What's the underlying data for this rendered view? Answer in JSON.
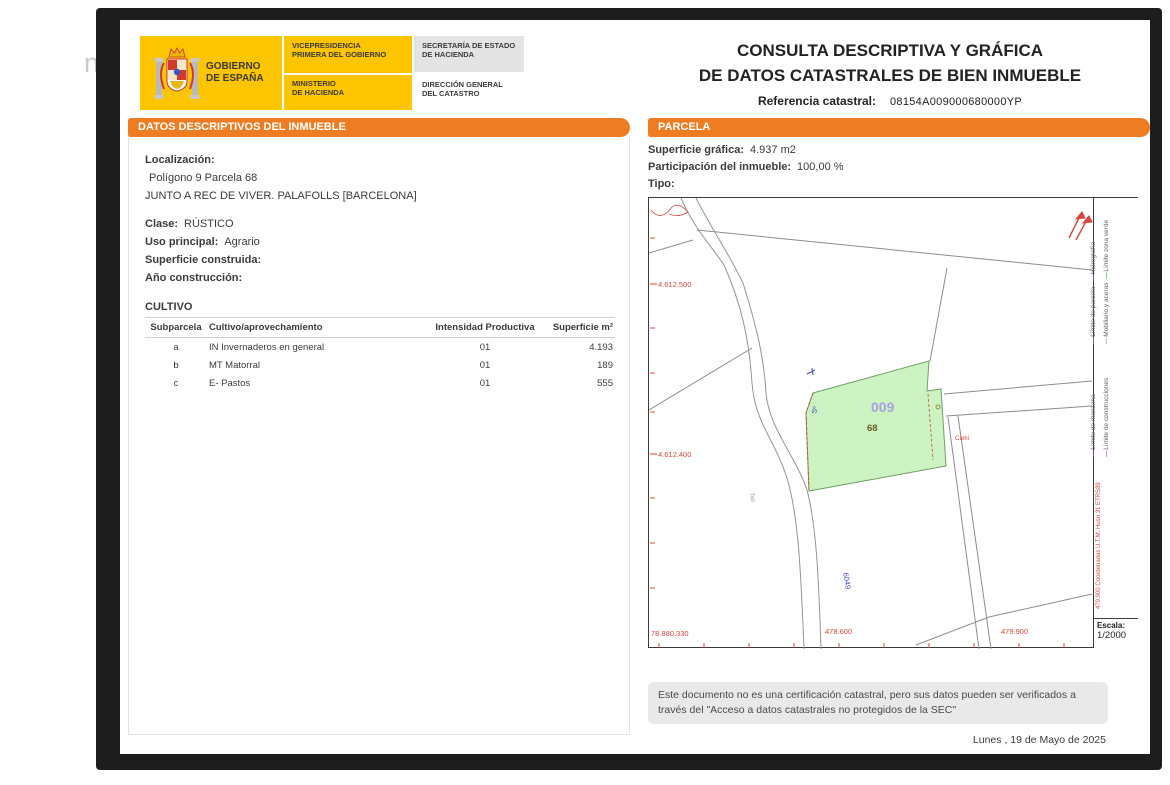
{
  "window": {
    "background_fragment": "ni"
  },
  "header": {
    "gobierno": "GOBIERNO\nDE ESPAÑA",
    "vicepresidencia": "VICEPRESIDENCIA\nPRIMERA DEL GOBIERNO",
    "ministerio": "MINISTERIO\nDE HACIENDA",
    "secretaria": "SECRETARÍA DE ESTADO\nDE HACIENDA",
    "direccion": "DIRECCIÓN GENERAL\nDEL CATASTRO"
  },
  "title": {
    "line1": "CONSULTA DESCRIPTIVA Y GRÁFICA",
    "line2": "DE DATOS CATASTRALES DE BIEN INMUEBLE",
    "ref_label": "Referencia catastral:",
    "ref_value": "08154A009000680000YP"
  },
  "left_panel": {
    "header": "DATOS DESCRIPTIVOS DEL INMUEBLE",
    "localizacion_label": "Localización:",
    "localizacion_line1": "Polígono 9 Parcela 68",
    "localizacion_line2": "JUNTO A REC DE VIVER. PALAFOLLS [BARCELONA]",
    "clase_label": "Clase:",
    "clase_value": "RÚSTICO",
    "uso_label": "Uso principal:",
    "uso_value": "Agrario",
    "superficie_label": "Superficie construida:",
    "ano_label": "Año construcción:",
    "cultivo_title": "CULTIVO",
    "table": {
      "columns": [
        "Subparcela",
        "Cultivo/aprovechamiento",
        "Intensidad Productiva",
        "Superficie m²"
      ],
      "rows": [
        [
          "a",
          "IN Invernaderos en general",
          "01",
          "4.193"
        ],
        [
          "b",
          "MT Matorral",
          "01",
          "189"
        ],
        [
          "c",
          "E- Pastos",
          "01",
          "555"
        ]
      ]
    }
  },
  "right_panel": {
    "header": "PARCELA",
    "superficie_label": "Superficie gráfica:",
    "superficie_value": "4.937 m2",
    "participacion_label": "Participación del inmueble:",
    "participacion_value": "100,00 %",
    "tipo_label": "Tipo:"
  },
  "map": {
    "parcel_number": "009",
    "parcel_sub": "68",
    "coord_left_top": "4.612.500",
    "coord_left_bottom": "4.612.400",
    "coord_bottom_left": "78.880.330",
    "coord_bottom_mid": "478.600",
    "coord_bottom_right": "479.900",
    "rotated_coords_text": "479.900 Coordenadas U.T.M. Huso 31 ETRS89",
    "blue_label_1": "Sº",
    "blue_label_2": "6049",
    "gray_label": "Tas",
    "red_label": "Camí",
    "escala_label": "Escala:",
    "escala_value": "1/2000",
    "colors": {
      "parcel_fill": "#cdf3c3",
      "coordinate_red": "#d8453e",
      "parcel_label_lilac": "#ab9fe2",
      "orange_accent": "#ed7c23"
    },
    "legend": {
      "items": [
        {
          "label": "Límite de manzana",
          "color": "#b055c8"
        },
        {
          "label": "Límite de construcciones",
          "color": "#d05050"
        },
        {
          "label": "Límite de parcela",
          "color": "#8c8c8c"
        },
        {
          "label": "Hidrografía",
          "color": "#5565d0"
        },
        {
          "label": "Mobiliario y aceras",
          "color": "#a8a8a8"
        },
        {
          "label": "Límite zona verde",
          "color": "#58a858"
        }
      ]
    }
  },
  "footer": {
    "disclaimer": "Este documento no es una certificación catastral, pero sus datos pueden ser verificados a través del \"Acceso a datos catastrales no protegidos de la SEC\"",
    "date": "Lunes , 19 de Mayo de 2025"
  }
}
